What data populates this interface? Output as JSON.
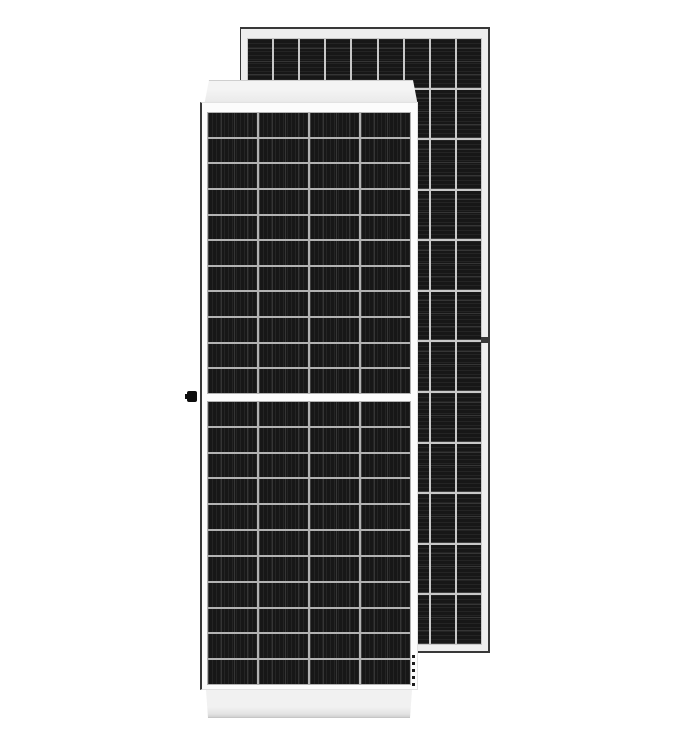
{
  "scene": {
    "description": "Product image of two framed half-cut-cell monocrystalline solar panels: a front-view module overlapping a taller rear module tilted behind it. No text is rendered in the image.",
    "background_color": "#ffffff"
  },
  "panels": {
    "front": {
      "name": "front solar panel",
      "view": "front, upright",
      "grid_upper": {
        "columns": 4,
        "rows": 11,
        "stripe": "vertical"
      },
      "grid_lower": {
        "columns": 4,
        "rows": 11,
        "stripe": "vertical"
      },
      "center_gap": "white horizontal split between upper and lower cell halves",
      "details": [
        "white top frame bar",
        "white bottom frame bar",
        "black grounding clip on left edge at mid height"
      ]
    },
    "rear": {
      "name": "rear solar panel",
      "view": "offset behind and to the right",
      "grid": {
        "columns": 9,
        "rows": 12,
        "stripe": "horizontal"
      },
      "details": [
        "light gray frame with dark outline",
        "mounting hole on right frame rail",
        "short dashed cable below lower-right of front panel"
      ]
    }
  },
  "colors": {
    "background": "#ffffff",
    "frame_light": "#eeeeee",
    "frame_edge_dark": "#383838",
    "panel_white": "#fcfcfc",
    "cell_dark": "#171717",
    "gap_front": "#b2b2b2",
    "gap_back": "#c8c8c8",
    "knob_black": "#0e0e0e",
    "cable_dark": "#1a1a1a"
  }
}
